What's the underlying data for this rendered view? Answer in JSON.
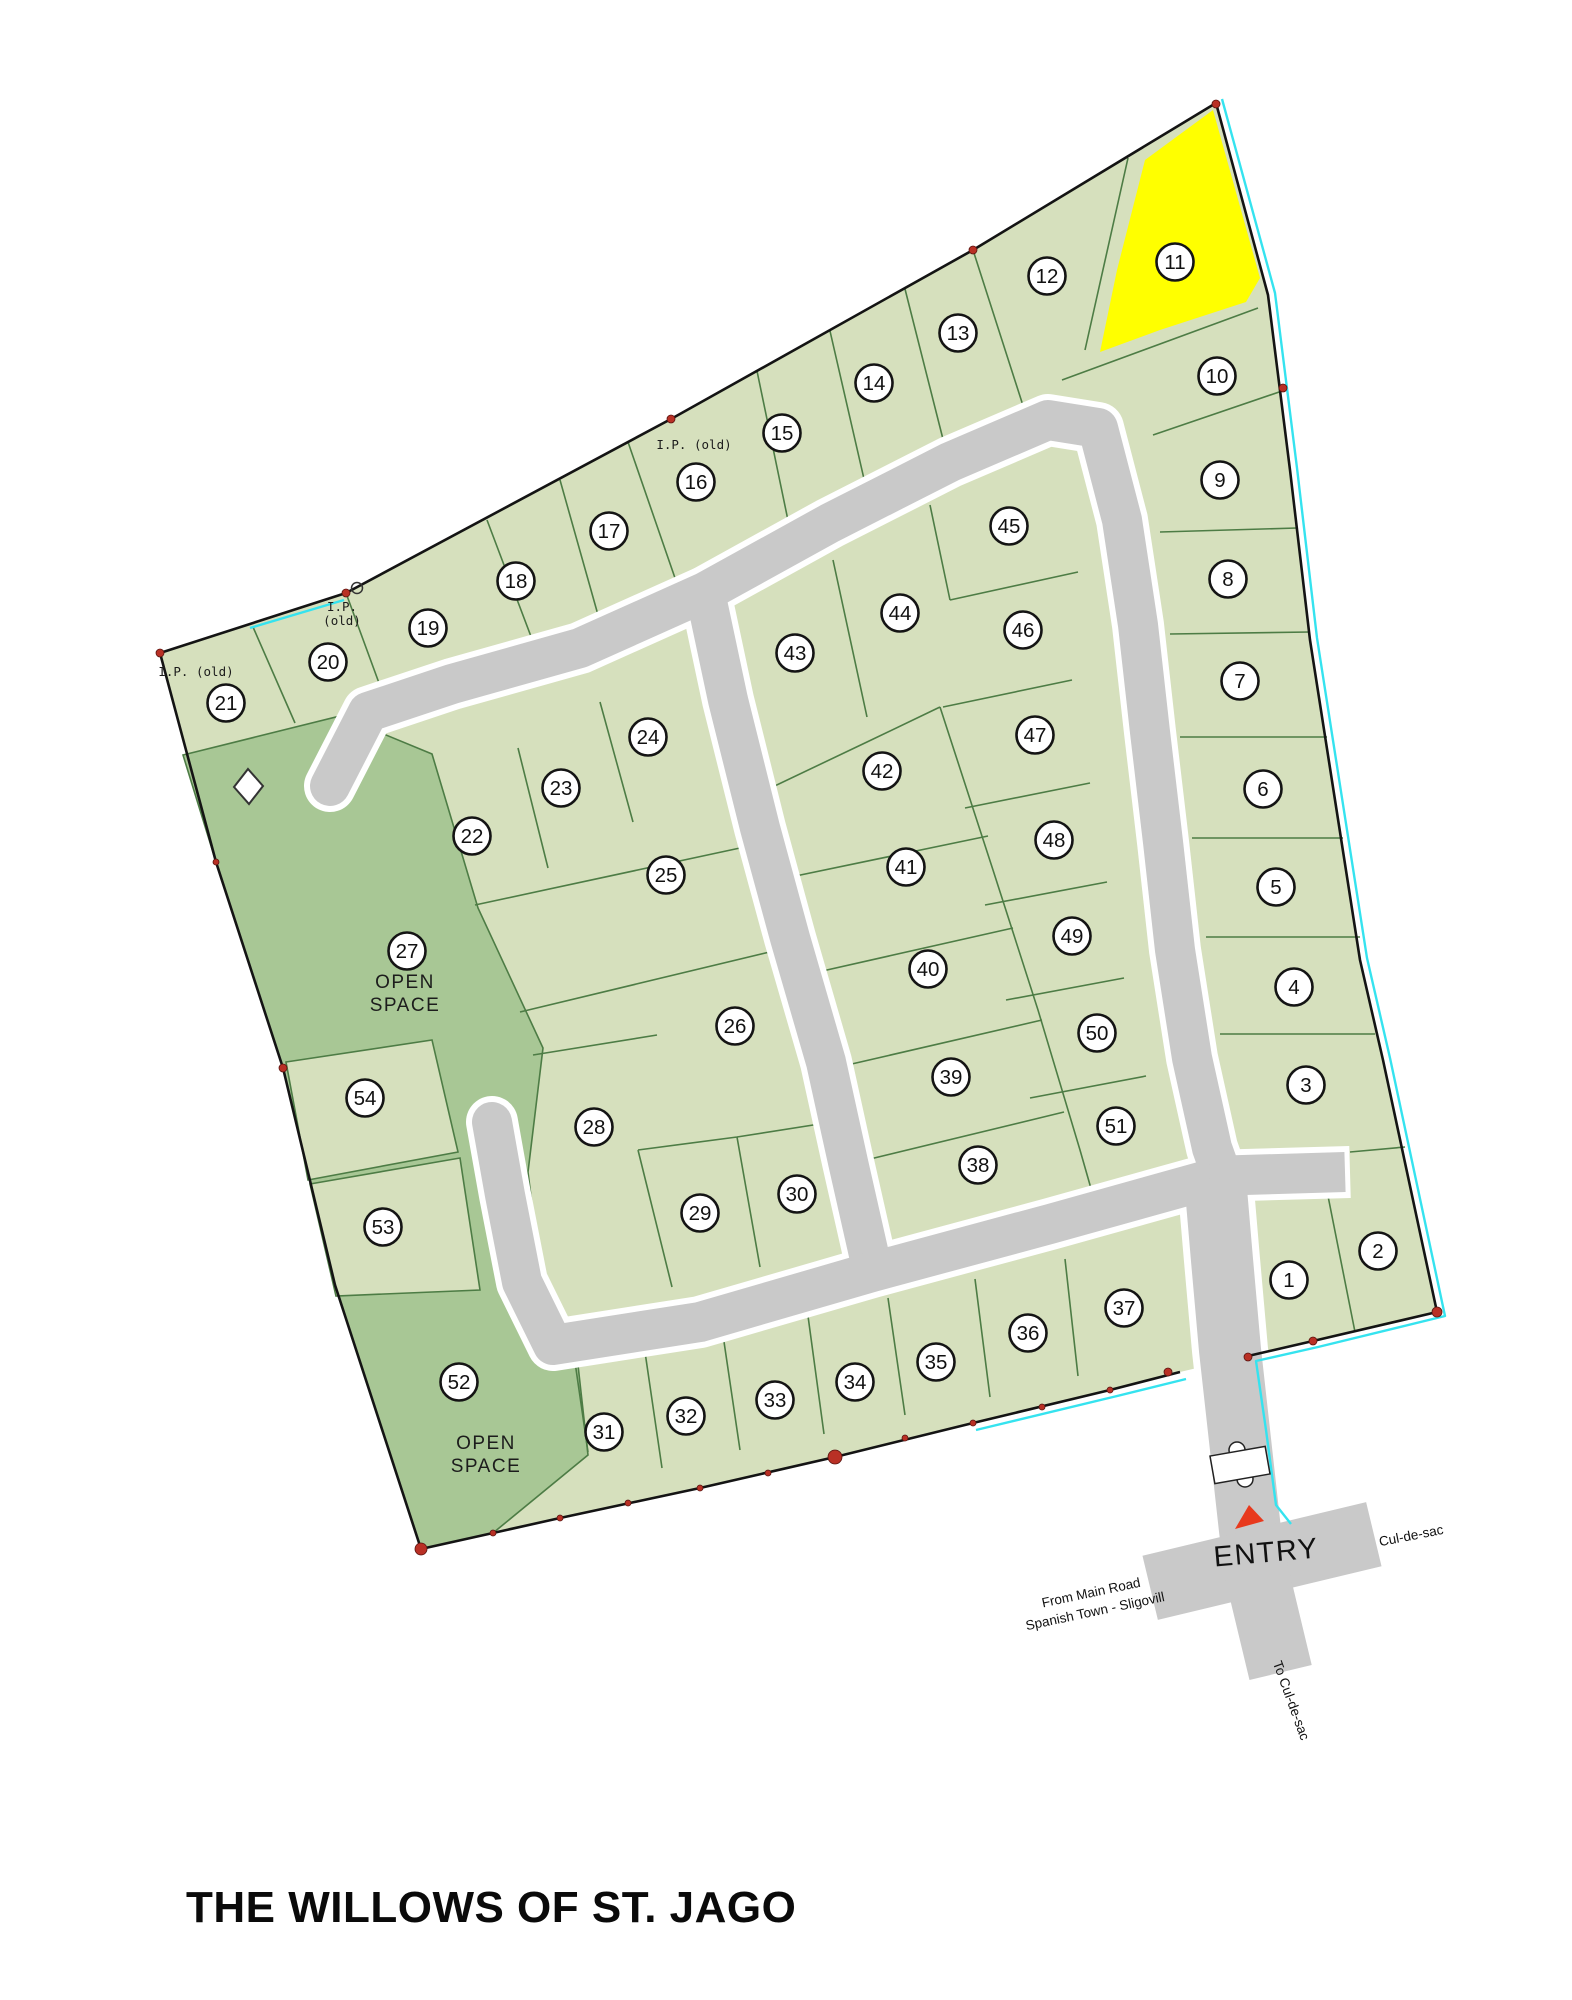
{
  "title": "THE WILLOWS OF ST. JAGO",
  "colors": {
    "lot_fill": "#d6e0bd",
    "open_space_fill": "#a8c795",
    "highlight_yellow": "#ffff00",
    "road_gray": "#c9c9c9",
    "road_casing": "#ffffff",
    "lot_line_green": "#4d7c45",
    "boundary_black": "#141414",
    "survey_line_cyan": "#35e3ef",
    "survey_marker_red": "#b93025",
    "entry_arrow_red": "#e8391d",
    "background": "#ffffff",
    "text": "#111111"
  },
  "map": {
    "highlighted_lot": "11",
    "open_space_lots": [
      "27",
      "52"
    ],
    "lots": [
      {
        "n": "1",
        "x": 1289,
        "y": 1280
      },
      {
        "n": "2",
        "x": 1378,
        "y": 1251
      },
      {
        "n": "3",
        "x": 1306,
        "y": 1085
      },
      {
        "n": "4",
        "x": 1294,
        "y": 987
      },
      {
        "n": "5",
        "x": 1276,
        "y": 887
      },
      {
        "n": "6",
        "x": 1263,
        "y": 789
      },
      {
        "n": "7",
        "x": 1240,
        "y": 681
      },
      {
        "n": "8",
        "x": 1228,
        "y": 579
      },
      {
        "n": "9",
        "x": 1220,
        "y": 480
      },
      {
        "n": "10",
        "x": 1217,
        "y": 376
      },
      {
        "n": "11",
        "x": 1175,
        "y": 262
      },
      {
        "n": "12",
        "x": 1047,
        "y": 276
      },
      {
        "n": "13",
        "x": 958,
        "y": 333
      },
      {
        "n": "14",
        "x": 874,
        "y": 383
      },
      {
        "n": "15",
        "x": 782,
        "y": 433
      },
      {
        "n": "16",
        "x": 696,
        "y": 482
      },
      {
        "n": "17",
        "x": 609,
        "y": 531
      },
      {
        "n": "18",
        "x": 516,
        "y": 581
      },
      {
        "n": "19",
        "x": 428,
        "y": 628
      },
      {
        "n": "20",
        "x": 328,
        "y": 662
      },
      {
        "n": "21",
        "x": 226,
        "y": 703
      },
      {
        "n": "22",
        "x": 472,
        "y": 836
      },
      {
        "n": "23",
        "x": 561,
        "y": 788
      },
      {
        "n": "24",
        "x": 648,
        "y": 737
      },
      {
        "n": "25",
        "x": 666,
        "y": 875
      },
      {
        "n": "26",
        "x": 735,
        "y": 1026
      },
      {
        "n": "27",
        "x": 407,
        "y": 951
      },
      {
        "n": "28",
        "x": 594,
        "y": 1127
      },
      {
        "n": "29",
        "x": 700,
        "y": 1213
      },
      {
        "n": "30",
        "x": 797,
        "y": 1194
      },
      {
        "n": "31",
        "x": 604,
        "y": 1432
      },
      {
        "n": "32",
        "x": 686,
        "y": 1416
      },
      {
        "n": "33",
        "x": 775,
        "y": 1400
      },
      {
        "n": "34",
        "x": 855,
        "y": 1382
      },
      {
        "n": "35",
        "x": 936,
        "y": 1362
      },
      {
        "n": "36",
        "x": 1028,
        "y": 1333
      },
      {
        "n": "37",
        "x": 1124,
        "y": 1308
      },
      {
        "n": "38",
        "x": 978,
        "y": 1165
      },
      {
        "n": "39",
        "x": 951,
        "y": 1077
      },
      {
        "n": "40",
        "x": 928,
        "y": 969
      },
      {
        "n": "41",
        "x": 906,
        "y": 867
      },
      {
        "n": "42",
        "x": 882,
        "y": 771
      },
      {
        "n": "43",
        "x": 795,
        "y": 653
      },
      {
        "n": "44",
        "x": 900,
        "y": 613
      },
      {
        "n": "45",
        "x": 1009,
        "y": 526
      },
      {
        "n": "46",
        "x": 1023,
        "y": 630
      },
      {
        "n": "47",
        "x": 1035,
        "y": 735
      },
      {
        "n": "48",
        "x": 1054,
        "y": 840
      },
      {
        "n": "49",
        "x": 1072,
        "y": 936
      },
      {
        "n": "50",
        "x": 1097,
        "y": 1033
      },
      {
        "n": "51",
        "x": 1116,
        "y": 1126
      },
      {
        "n": "52",
        "x": 459,
        "y": 1382
      },
      {
        "n": "53",
        "x": 383,
        "y": 1227
      },
      {
        "n": "54",
        "x": 365,
        "y": 1098
      }
    ],
    "text_labels": [
      {
        "id": "open-space-27-label",
        "lines": [
          "OPEN",
          "SPACE"
        ],
        "x": 405,
        "y": 988,
        "rot": 0,
        "size": 19,
        "lh": 23,
        "cls": "lbl-open"
      },
      {
        "id": "open-space-52-label",
        "lines": [
          "OPEN",
          "SPACE"
        ],
        "x": 486,
        "y": 1449,
        "rot": 0,
        "size": 19,
        "lh": 23,
        "cls": "lbl-open"
      },
      {
        "id": "ip-old-label-west",
        "lines": [
          "I.P. (old)"
        ],
        "x": 196,
        "y": 676,
        "rot": 0,
        "size": 12.5,
        "lh": 14,
        "cls": "lbl-ip"
      },
      {
        "id": "ip-old-label-mid",
        "lines": [
          "I.P.",
          "(old)"
        ],
        "x": 342,
        "y": 611,
        "rot": 0,
        "size": 12.5,
        "lh": 14,
        "cls": "lbl-ip"
      },
      {
        "id": "ip-old-label-north",
        "lines": [
          "I.P. (old)"
        ],
        "x": 694,
        "y": 449,
        "rot": 0,
        "size": 12.5,
        "lh": 14,
        "cls": "lbl-ip"
      },
      {
        "id": "entry-label",
        "lines": [
          "ENTRY"
        ],
        "x": 1267,
        "y": 1562,
        "rot": -5,
        "size": 29,
        "lh": 30,
        "cls": "lbl-entry"
      },
      {
        "id": "cul-de-sac-label",
        "lines": [
          "Cul-de-sac"
        ],
        "x": 1412,
        "y": 1540,
        "rot": -11,
        "size": 13.5,
        "lh": 16,
        "cls": ""
      },
      {
        "id": "from-main-road-label",
        "lines": [
          "From Main Road",
          "Spanish Town - Sligovill"
        ],
        "x": 1092,
        "y": 1597,
        "rot": -12,
        "size": 13.5,
        "lh": 19,
        "cls": ""
      },
      {
        "id": "to-cul-de-sac-label",
        "lines": [
          "To Cul-de-sac"
        ],
        "x": 1287,
        "y": 1702,
        "rot": 70,
        "size": 13.5,
        "lh": 16,
        "cls": ""
      }
    ],
    "survey_markers": [
      [
        1216,
        104,
        4
      ],
      [
        973,
        250,
        4
      ],
      [
        671,
        419,
        4
      ],
      [
        346,
        593,
        4
      ],
      [
        160,
        653,
        4
      ],
      [
        216,
        862,
        3
      ],
      [
        283,
        1068,
        4
      ],
      [
        421,
        1549,
        6
      ],
      [
        493,
        1533,
        3
      ],
      [
        560,
        1518,
        3
      ],
      [
        628,
        1503,
        3
      ],
      [
        700,
        1488,
        3
      ],
      [
        768,
        1473,
        3
      ],
      [
        835,
        1457,
        7
      ],
      [
        905,
        1438,
        3
      ],
      [
        973,
        1423,
        3
      ],
      [
        1042,
        1407,
        3
      ],
      [
        1110,
        1390,
        3
      ],
      [
        1168,
        1372,
        4
      ],
      [
        1248,
        1357,
        4
      ],
      [
        1313,
        1341,
        4
      ],
      [
        1437,
        1312,
        5
      ],
      [
        1283,
        388,
        4
      ]
    ]
  }
}
